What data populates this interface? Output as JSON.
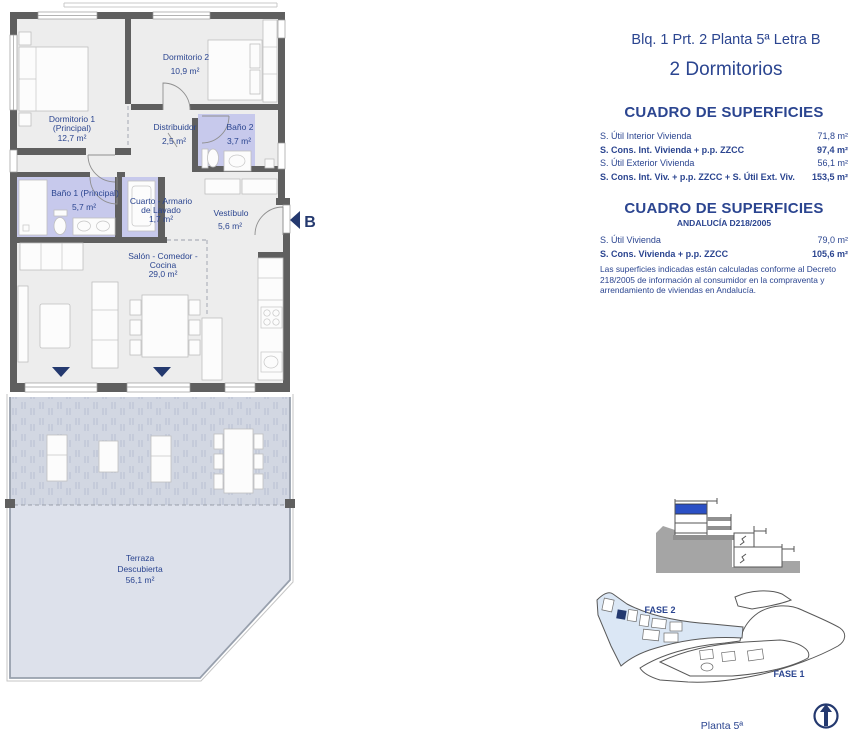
{
  "header": {
    "line1": "Blq. 1 Prt. 2 Planta 5ª Letra B",
    "line2": "2 Dormitorios"
  },
  "surfaces": {
    "title": "CUADRO DE SUPERFICIES",
    "rows": [
      {
        "label": "S. Útil Interior Vivienda",
        "value": "71,8 m²"
      },
      {
        "label": "S. Cons. Int. Vivienda + p.p. ZZCC",
        "value": "97,4 m²"
      },
      {
        "label": "S. Útil Exterior Vivienda",
        "value": "56,1 m²"
      },
      {
        "label": "S. Cons. Int. Viv. + p.p. ZZCC + S. Útil Ext. Viv.",
        "value": "153,5 m²"
      }
    ]
  },
  "surfaces_andalucia": {
    "title": "CUADRO DE SUPERFICIES",
    "subtitle": "ANDALUCÍA D218/2005",
    "rows": [
      {
        "label": "S. Útil Vivienda",
        "value": "79,0 m²"
      },
      {
        "label": "S. Cons. Vivienda + p.p. ZZCC",
        "value": "105,6 m²"
      }
    ],
    "note": "Las superficies indicadas están calculadas conforme al Decreto 218/2005 de información al consumidor en la compraventa y arrendamiento de viviendas en Andalucía."
  },
  "plan": {
    "rooms": {
      "dormitorio2": {
        "name": "Dormitorio 2",
        "area": "10,9 m²"
      },
      "dormitorio1": {
        "name": "Dormitorio 1",
        "name2": "(Principal)",
        "area": "12,7 m²"
      },
      "distribuidor": {
        "name": "Distribuidor",
        "area": "2,5 m²"
      },
      "bano2": {
        "name": "Baño 2",
        "area": "3,7 m²"
      },
      "bano1": {
        "name": "Baño 1 (Principal)",
        "area": "5,7 m²"
      },
      "lavado": {
        "name": "Cuarto - Armario",
        "name2": "de Lavado",
        "area": "1,7 m²"
      },
      "vestibulo": {
        "name": "Vestíbulo",
        "area": "5,6 m²"
      },
      "salon": {
        "name": "Salón - Comedor -",
        "name2": "Cocina",
        "area": "29,0 m²"
      },
      "terraza": {
        "name": "Terraza",
        "name2": "Descubierta",
        "area": "56,1 m²"
      }
    },
    "entrance_letter": "B"
  },
  "site": {
    "fase2": "FASE 2",
    "fase1": "FASE 1",
    "caption": "Planta 5ª"
  },
  "colors": {
    "navy": "#2b4590",
    "navydark": "#24396f",
    "wall": "#5f5f5f",
    "wet": "#c7c9ec",
    "tercov": "#d2d7e2",
    "teropen": "#dde1eb",
    "royal": "#2b50c5",
    "fase2fill": "#dbe7f5"
  }
}
